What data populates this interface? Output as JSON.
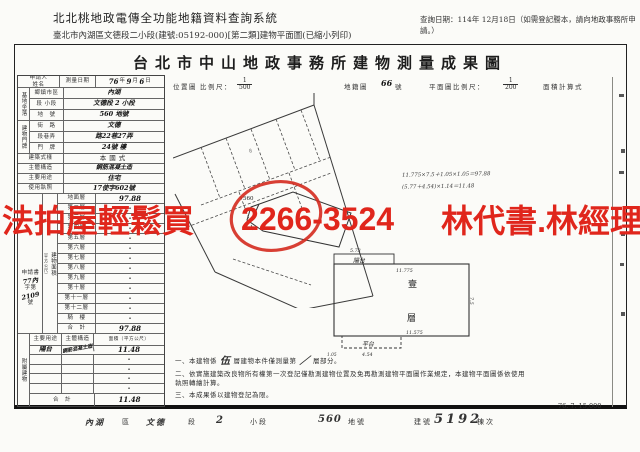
{
  "app_header": {
    "title": "北北桃地政電傳全功能地籍資料查詢系統",
    "query_date": "查詢日期：114年 12月18日（如需登記謄本，請向地政事務所申請。）",
    "subtitle": "臺北市內湖區文德段二小段(建號:05192-000)[第二類]建物平面圖(已縮小列印)"
  },
  "doc": {
    "title": "台北市中山地政事務所建物測量成果圖",
    "scale_row": {
      "loc_label": "位置圖",
      "ratio_label": "比例尺：",
      "loc_num": "1",
      "loc_den": "500",
      "cad_label": "地籍圖",
      "cad_value": "66",
      "cad_suffix": "號",
      "plan_label": "平面圖比例尺：",
      "plan_num": "1",
      "plan_den": "200",
      "calc_label": "面積計算式"
    },
    "form": {
      "applicant_label": "申請人",
      "applicant_name_label": "姓名",
      "survey_date_label": "測量日期",
      "survey_date": {
        "y": "76",
        "y_label": "年",
        "m": "9",
        "m_label": "月",
        "d": "6",
        "d_label": "日"
      },
      "site_group": "基地坐落",
      "site_rows": [
        {
          "label": "鄉鎮市區",
          "value": "內湖"
        },
        {
          "label": "段 小段",
          "value": "文德段 2 小段"
        },
        {
          "label": "地　號",
          "value": "560 地號"
        }
      ],
      "door_group": "建物門牌",
      "door_rows": [
        {
          "label": "街　路",
          "value": "文德"
        },
        {
          "label": "段巷弄",
          "value": "路22巷27弄"
        },
        {
          "label": "門　牌",
          "value": "24號 樓"
        }
      ],
      "info_rows": [
        {
          "label": "建築式樣",
          "value": "本國式"
        },
        {
          "label": "主體構造",
          "value": "鋼筋混凝土造"
        },
        {
          "label": "主要用途",
          "value": "住宅"
        },
        {
          "label": "使用執照",
          "value": "17使字602號"
        }
      ],
      "area_group": "建物面積",
      "area_group_unit": "（平方公尺）",
      "floors": [
        {
          "label": "地面層",
          "value": "97.88"
        },
        {
          "label": "第二層",
          "value": "·"
        },
        {
          "label": "第三層",
          "value": "·"
        },
        {
          "label": "第四層",
          "value": "·"
        },
        {
          "label": "第五層",
          "value": "·"
        },
        {
          "label": "第六層",
          "value": "·"
        },
        {
          "label": "第七層",
          "value": "·"
        },
        {
          "label": "第八層",
          "value": "·"
        },
        {
          "label": "第九層",
          "value": "·"
        },
        {
          "label": "第十層",
          "value": "·"
        },
        {
          "label": "第十一層",
          "value": "·"
        },
        {
          "label": "第十二層",
          "value": "·"
        },
        {
          "label": "騎　樓",
          "value": "·"
        },
        {
          "label": "合　計",
          "value": "97.88"
        }
      ],
      "stamp": {
        "l1": "申請書",
        "l2": "77內",
        "l3": "字第",
        "l4": "2109",
        "l5": "號"
      },
      "annex_group": "附屬建物",
      "annex_header": {
        "use": "主要用途",
        "structure": "主體構造",
        "area": "面積（平方公尺）"
      },
      "annex_rows": [
        {
          "use": "陽台",
          "structure": "鋼筋混凝土造",
          "area": "11.48"
        },
        {
          "use": "",
          "structure": "",
          "area": "·"
        },
        {
          "use": "",
          "structure": "",
          "area": "·"
        },
        {
          "use": "",
          "structure": "",
          "area": "·"
        },
        {
          "use": "",
          "structure": "",
          "area": "·"
        }
      ],
      "annex_total_label": "合　計",
      "annex_total_value": "11.48"
    },
    "site_map": {
      "parcel_number": "560",
      "neighbor_mark": "8"
    },
    "calc_lines": {
      "line1": "11.775×7.5＋1.05×1.05＝97.88",
      "line2": "(5.77＋4.54)×1.14＝11.48"
    },
    "floor_plan": {
      "floor_char1": "壹",
      "floor_char2": "層",
      "balcony": "陽台",
      "balcony_dim": "5.73",
      "top_dim": "11.775",
      "right_dim": "7.5",
      "bottom_dim": "11.575",
      "platform": "平台",
      "platform_dim": "4.54",
      "corner_dim": "1.05"
    },
    "notes": {
      "n1a": "一、本建物係",
      "n1_hand1": "伍",
      "n1b": "層建物本件僅測量第",
      "n1_hand2": "／",
      "n1c": "層部分。",
      "n2": "二、依實施建築改良物所有權第一次登記僅勘測建物位置及免再勘測建物平面圖作業規定，本建物平面圖係依使用執照轉繪計算。",
      "n3": "三、本成果係以建物登記為限。"
    },
    "print_code": "76. 7. 15,000",
    "footer_row": {
      "district": "內湖",
      "district_label": "區",
      "section": "文德",
      "section_label": "段",
      "subsection": "2",
      "subsection_label": "小段",
      "parcel": "560",
      "parcel_label": "地號",
      "building_label": "建號",
      "building_no": "5192",
      "unit_label": "棟次"
    }
  },
  "watermark": {
    "left": "法拍屋輕鬆買",
    "phone": "2266-3524",
    "right": "林代書.林經理",
    "color": "#e0261c"
  }
}
